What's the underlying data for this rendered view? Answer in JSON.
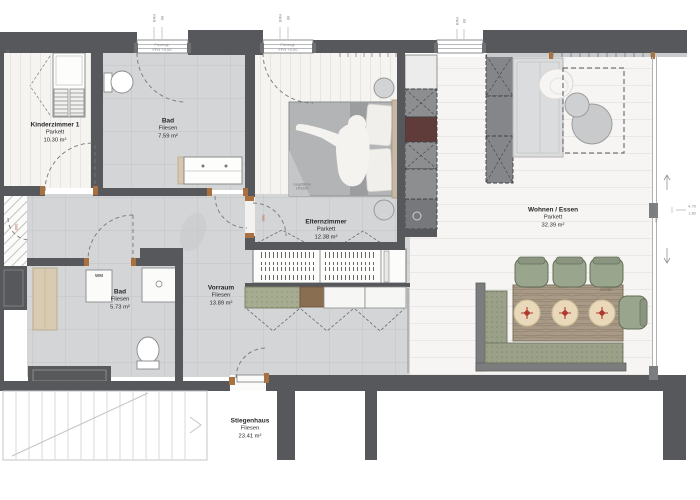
{
  "title": "Apartment floor plan (Grundriss)",
  "rooms": [
    {
      "name": "Kinderzimmer 1",
      "floor": "Parkett",
      "area": "10.30 m²"
    },
    {
      "name": "Bad",
      "floor": "Fliesen",
      "area": "7.59 m²"
    },
    {
      "name": "Elternzimmer",
      "floor": "Parkett",
      "area": "12.38 m²"
    },
    {
      "name": "Wohnen / Essen",
      "floor": "Parkett",
      "area": "32.39 m²"
    },
    {
      "name": "Vorraum",
      "floor": "Fliesen",
      "area": "13.89 m²"
    },
    {
      "name": "Bad",
      "floor": "Fliesen",
      "area": "5.73 m²"
    },
    {
      "name": "Stiegenhaus",
      "floor": "Fliesen",
      "area": "23.41 m²"
    }
  ],
  "annotations": {
    "window_line1": "Fixvergl.",
    "window_line2": "FFH +0,00",
    "brh_label": "BRH",
    "brh_value": "88",
    "bed_line1": "Liegefläche",
    "bed_line2": "140/200",
    "table_size": "230/080",
    "washer": "WM",
    "door_dim_eltern": "900",
    "door_dim_shaft": "800",
    "edge_top_left": "0,",
    "right_dim_a": "4,76",
    "right_dim_b": "1,80",
    "right_ffh": "FFH ±0,00"
  },
  "colors": {
    "wall": "#57585c",
    "tile_floor": "#d4d5d7",
    "parquet_floor": "#f5f4f1",
    "bench_olive": "#9ba189",
    "sideboard_green": "#a6ac90",
    "sideboard_brown": "#8a6e52",
    "table_wood": "#a89a87",
    "oven_red": "#5f3b39",
    "plate_cream": "#e9d9ba",
    "plate_motif_red": "#b0392f",
    "door_frame_brown": "#a8713f",
    "bed_blanket": "#b3b4b6",
    "headboard_tan": "#c8b8a1"
  }
}
